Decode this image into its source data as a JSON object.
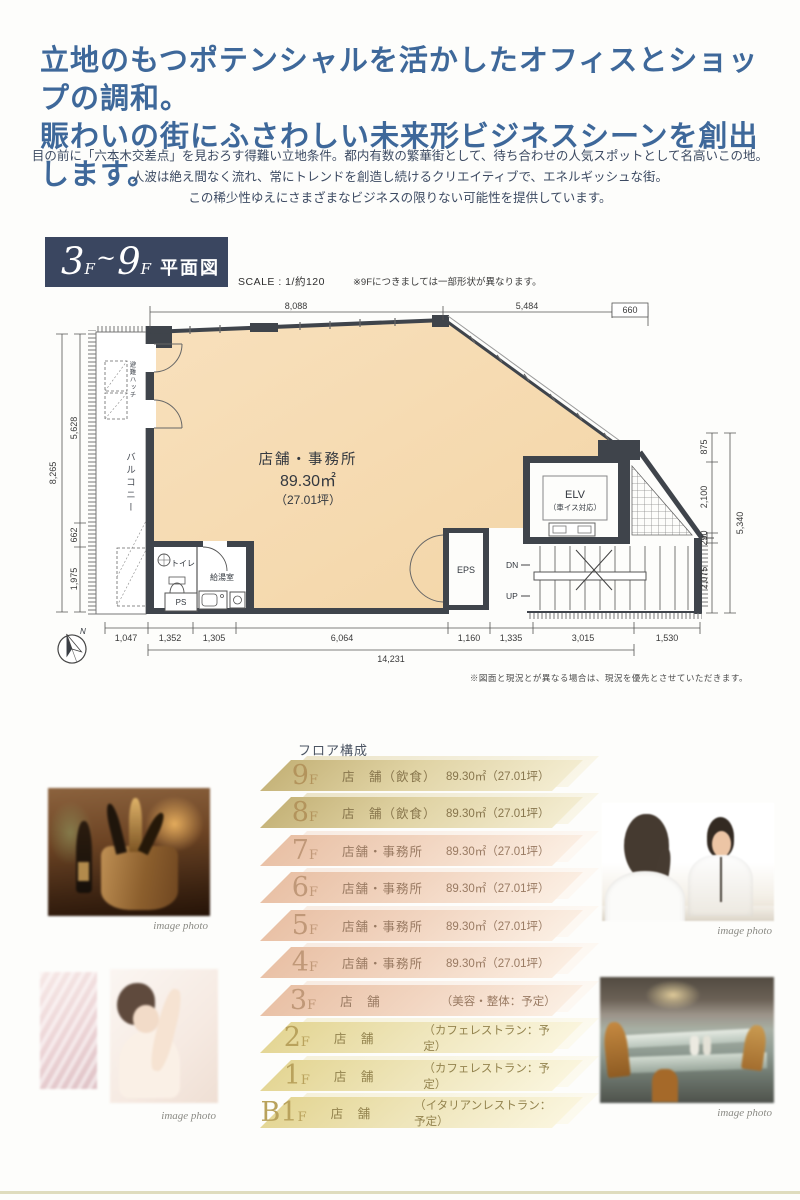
{
  "header": {
    "headline1": "立地のもつポテンシャルを活かしたオフィスとショップの調和。",
    "headline2": "賑わいの街にふさわしい未来形ビジネスシーンを創出します。",
    "intro1": "目の前に「六本木交差点」を見おろす得難い立地条件。都内有数の繁華街として、待ち合わせの人気スポットとして名高いこの地。",
    "intro2": "人波は絶え間なく流れ、常にトレンドを創造し続けるクリエイティブで、エネルギッシュな街。",
    "intro3": "この稀少性ゆえにさまざまなビジネスの限りない可能性を提供しています。"
  },
  "plan_header": {
    "range_num1": "3",
    "range_f1": "F",
    "range_tilde": "~",
    "range_num2": "9",
    "range_f2": "F",
    "range_label": "平面図",
    "scale": "SCALE : 1/約120",
    "note": "※9Fにつきましては一部形状が異なります。"
  },
  "plan": {
    "room": "店舗・事務所",
    "area": "89.30㎡",
    "tsubo": "（27.01坪）",
    "elv": "ELV",
    "elv_sub": "（車イス対応）",
    "eps": "EPS",
    "toilet": "トイレ",
    "kitchen": "給湯室",
    "ps": "PS",
    "balcony": "バルコニー",
    "hatch": "避難ハッチ",
    "dn": "DN",
    "up": "UP",
    "north": "N",
    "dim_top": [
      "8,088",
      "5,484",
      "660"
    ],
    "dim_bottom": [
      "1,047",
      "1,352",
      "1,305",
      "6,064",
      "1,160",
      "1,335",
      "3,015",
      "1,530"
    ],
    "dim_bottom_total": "14,231",
    "dim_left": [
      "5,628",
      "662",
      "1,975"
    ],
    "dim_left_total": "8,265",
    "dim_right": [
      "875",
      "2,100",
      "290",
      "2,075"
    ],
    "dim_right_total": "5,340",
    "disclaimer": "※図面と現況とが異なる場合は、現況を優先とさせていただきます。"
  },
  "floors": {
    "title": "フロア構成",
    "rows": [
      {
        "num": "9",
        "f": "F",
        "use": "店　舗（飲食）",
        "area": "89.30㎡（27.01坪）"
      },
      {
        "num": "8",
        "f": "F",
        "use": "店　舗（飲食）",
        "area": "89.30㎡（27.01坪）"
      },
      {
        "num": "7",
        "f": "F",
        "use": "店舗・事務所",
        "area": "89.30㎡（27.01坪）"
      },
      {
        "num": "6",
        "f": "F",
        "use": "店舗・事務所",
        "area": "89.30㎡（27.01坪）"
      },
      {
        "num": "5",
        "f": "F",
        "use": "店舗・事務所",
        "area": "89.30㎡（27.01坪）"
      },
      {
        "num": "4",
        "f": "F",
        "use": "店舗・事務所",
        "area": "89.30㎡（27.01坪）"
      },
      {
        "num": "3",
        "f": "F",
        "use": "店　舗",
        "area": "（美容・整体：予定）"
      },
      {
        "num": "2",
        "f": "F",
        "use": "店　舗",
        "area": "（カフェレストラン：予定）"
      },
      {
        "num": "1",
        "f": "F",
        "use": "店　舗",
        "area": "（カフェレストラン：予定）"
      },
      {
        "num": "B1",
        "f": "F",
        "use": "店　舗",
        "area": "（イタリアンレストラン：予定）"
      }
    ]
  },
  "photos": {
    "caption": "image photo"
  },
  "colors": {
    "headline_blue": "#3e689a",
    "title_box_navy": "#3a4660",
    "plan_room_fill": "#f5d9ae",
    "band_gold": "#d5c48c",
    "band_pink": "#eecbb2",
    "band_cream": "#ebdfa4"
  }
}
